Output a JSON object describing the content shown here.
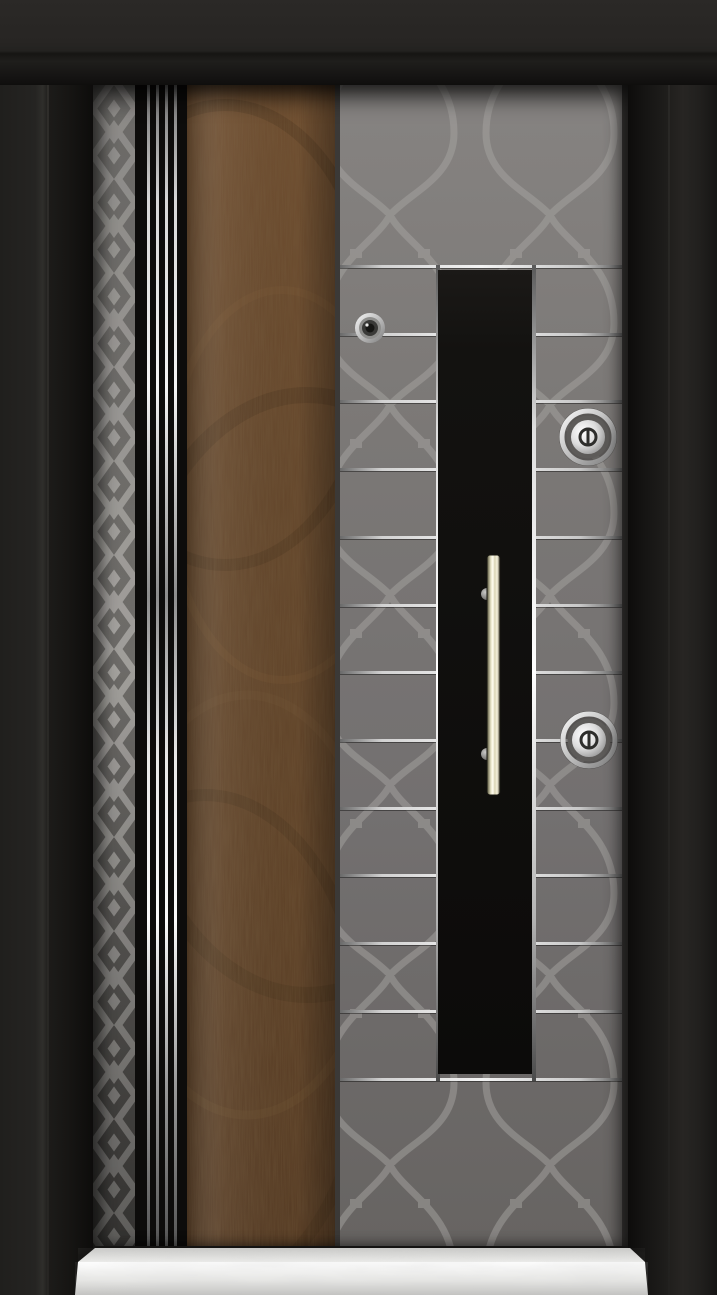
{
  "scene": {
    "kind": "product-photograph",
    "subject": "modern steel security entrance door, closed, front view",
    "background_color": "#12110f"
  },
  "door": {
    "frame": {
      "material": "matte black painted steel surround",
      "color": "#201f1d"
    },
    "leaf": {
      "diamond_strip": {
        "pattern": "etched diamond lattice",
        "bg_color": "#757371",
        "band_color": "#a9a7a3"
      },
      "chrome_stripes": {
        "count": 4,
        "color": "#e9e9e9",
        "bg_color": "#0d0c0b",
        "offsets_px": [
          12,
          21,
          30,
          39
        ]
      },
      "wood_panel": {
        "material": "walnut veneer",
        "base_color": "#63452a",
        "dark_grain": "#3f2a16",
        "light_grain": "#7a5835"
      },
      "main_panel": {
        "bg_color": "#7a7876",
        "pattern": "quatrefoil ogee lattice etching",
        "pattern_color": "#a09e9b",
        "inlay_lines": {
          "count": 13,
          "color": "#ededed",
          "y_positions": [
            265,
            333,
            400,
            468,
            536,
            604,
            671,
            739,
            807,
            874,
            942,
            1010,
            1078
          ]
        }
      },
      "center_panel": {
        "color": "#121110",
        "border_finish": "chrome",
        "x": 438,
        "y": 270,
        "width": 94,
        "height": 804
      }
    },
    "hardware": {
      "peephole": {
        "finish": "chrome",
        "cx": 370,
        "cy": 328
      },
      "handle": {
        "type": "vertical pull bar",
        "finish": "satin gold",
        "x": 487,
        "y": 555,
        "width": 13,
        "height": 240
      },
      "locks": [
        {
          "name": "upper cylinder",
          "finish": "chrome",
          "cx": 588,
          "cy": 437
        },
        {
          "name": "lower cylinder",
          "finish": "chrome",
          "cx": 589,
          "cy": 740
        }
      ]
    },
    "threshold": {
      "material": "white marble sill",
      "color": "#efeeec"
    }
  }
}
